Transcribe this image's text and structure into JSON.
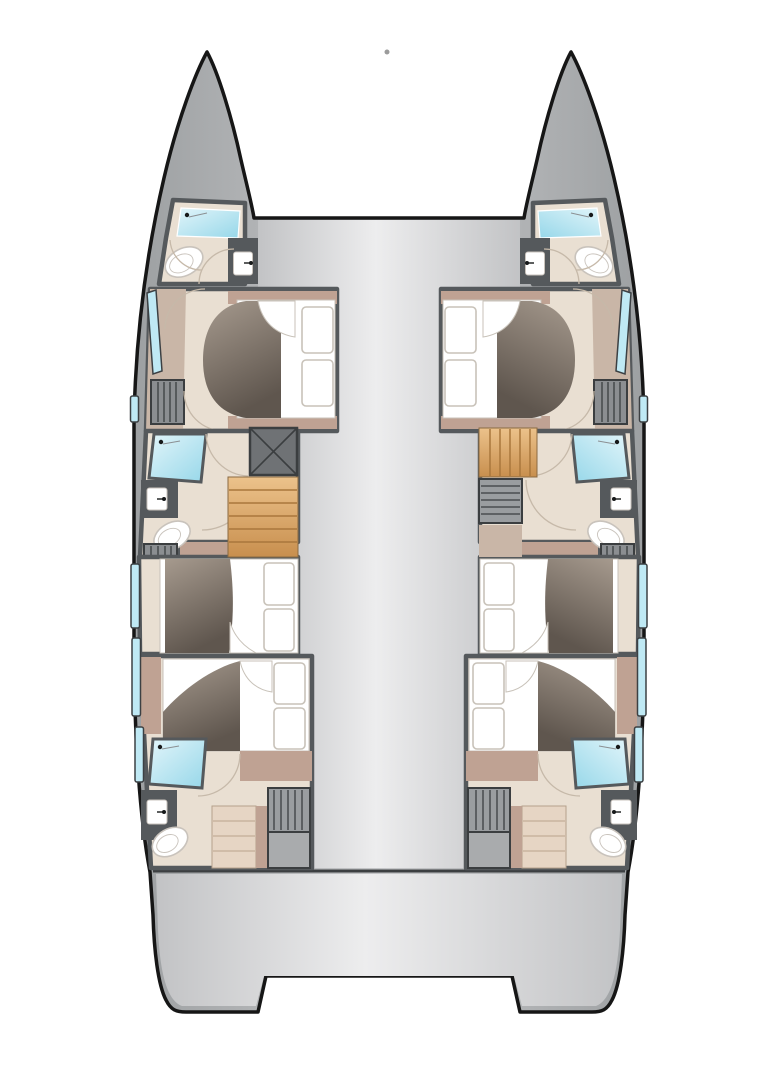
{
  "meta": {
    "diagram_type": "boat-floor-plan",
    "vessel_type": "catamaran",
    "view": "top-down-lower-deck",
    "visible_text": ""
  },
  "colors": {
    "outline": "#161616",
    "ink": "#17191a",
    "wall": "#55595c",
    "hull_edge": "#9da0a2",
    "hull_mid": "#c6c7c9",
    "deck_edge": "#c2c3c5",
    "deck_mid": "#ededee",
    "floor": "#e9dfd2",
    "headboard": "#bfa293",
    "wardrobe": "#c9b6a7",
    "duvet_light": "#a69a8e",
    "duvet_dark": "#5f564e",
    "linen": "#ffffff",
    "linen_edge": "#c8c2b9",
    "fixture_white": "#ffffff",
    "fixture_edge": "#c9c3bc",
    "shower_light": "#e2f5fa",
    "shower_blue": "#96d7e9",
    "window_blue": "#bfe9f4",
    "window_frame": "#3c4043",
    "wood_light": "#ecc28b",
    "wood_dark": "#c88f4e",
    "wood_line": "#a9773c",
    "hatch": "#8b8e91",
    "hatch_dark": "#6f7275",
    "hatch_line": "#3b3e40",
    "louver": "#9a9da0",
    "steps": "#e6d5c4",
    "steps_line": "#c9b49f",
    "arc_line": "#c6b9a9",
    "bulkhead_line": "#3c3f41",
    "fitting_gray": "#9b9b9b"
  },
  "plan": {
    "hulls": [
      {
        "id": "port-hull",
        "rooms": [
          {
            "name": "bow-bathroom",
            "fixtures": [
              "shower",
              "toilet",
              "sink"
            ]
          },
          {
            "name": "forward-cabin",
            "fixtures": [
              "double-bed",
              "pillows",
              "wardrobe",
              "louver-locker"
            ]
          },
          {
            "name": "stair-landing-bathroom",
            "fixtures": [
              "shower",
              "toilet",
              "sink",
              "floor-hatch",
              "companionway-stairs",
              "louver-seat"
            ]
          },
          {
            "name": "mid-cabin",
            "fixtures": [
              "double-bed",
              "pillows"
            ]
          },
          {
            "name": "aft-cabin",
            "fixtures": [
              "double-bed",
              "pillows",
              "shower",
              "toilet",
              "sink",
              "steps",
              "wardrobe-louver"
            ]
          }
        ],
        "hull_windows": 5
      },
      {
        "id": "starboard-hull",
        "rooms": [
          {
            "name": "bow-bathroom",
            "fixtures": [
              "shower",
              "toilet",
              "sink"
            ]
          },
          {
            "name": "forward-cabin",
            "fixtures": [
              "double-bed",
              "pillows",
              "wardrobe",
              "louver-locker"
            ]
          },
          {
            "name": "stair-landing-bathroom",
            "fixtures": [
              "shower",
              "toilet",
              "sink",
              "companionway-stairs",
              "louver-shelf",
              "louver-seat"
            ]
          },
          {
            "name": "mid-cabin",
            "fixtures": [
              "double-bed",
              "pillows"
            ]
          },
          {
            "name": "aft-cabin",
            "fixtures": [
              "double-bed",
              "pillows",
              "shower",
              "toilet",
              "sink",
              "steps",
              "wardrobe-louver"
            ]
          }
        ],
        "hull_windows": 5
      }
    ],
    "deck_areas": [
      "foredeck-gap",
      "center-bridgedeck",
      "aft-deck-with-notch"
    ],
    "bow_fitting": "forestay-dot"
  }
}
